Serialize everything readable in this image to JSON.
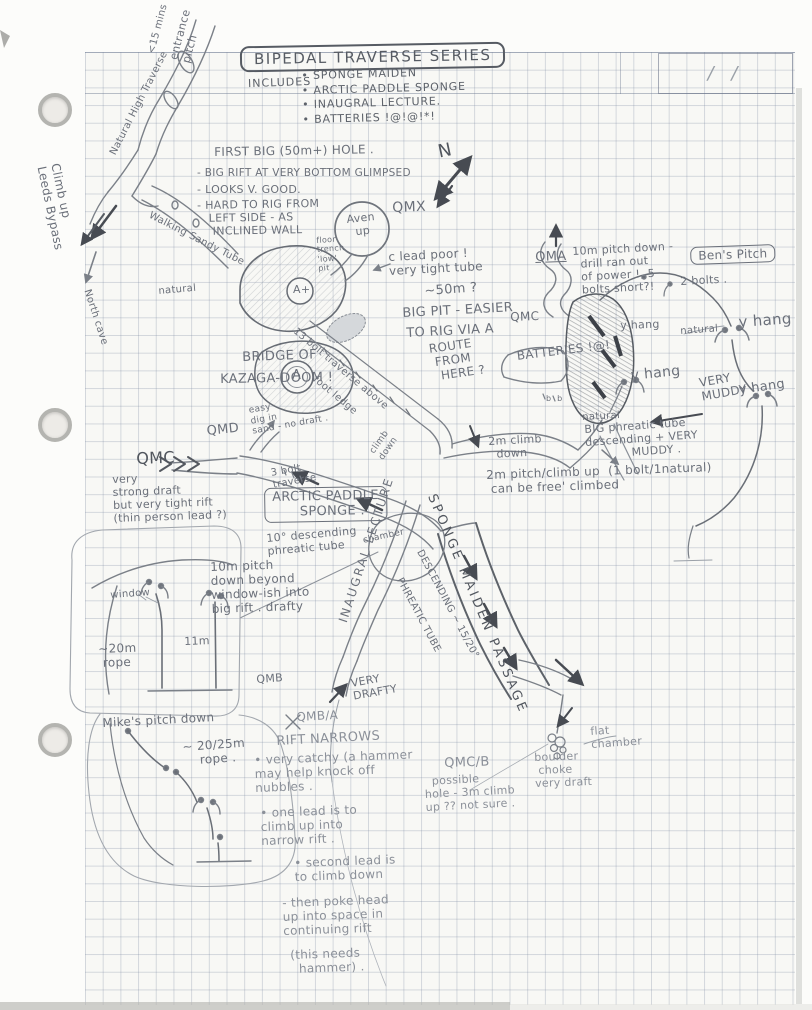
{
  "header": {
    "title": "BIPEDAL TRAVERSE SERIES",
    "includes_label": "INCLUDES",
    "includes": [
      "SPONGE MAIDEN",
      "ARCTIC PADDLE SPONGE",
      "INAUGRAL LECTURE.",
      "BATTERIES !@!@!*!"
    ],
    "date_box": "/    /"
  },
  "colors": {
    "pencil": "#6b707a",
    "pencil_dark": "#51565e",
    "pencil_faint": "#8b9099",
    "paper": "#f8f8f5",
    "grid_line": "#7d8aa2"
  },
  "annotations": [
    {
      "id": "entrance-pitch",
      "text": "entrance\npitch",
      "x": 168,
      "y": 58,
      "rot": -75,
      "fs": 11
    },
    {
      "id": "entrance-time",
      "text": "<15 mins",
      "x": 146,
      "y": 52,
      "rot": -75,
      "fs": 10
    },
    {
      "id": "natural-high-traverse",
      "text": "Natural High Traverse",
      "x": 108,
      "y": 152,
      "rot": -63,
      "fs": 10
    },
    {
      "id": "climb-up-leeds-bypass",
      "text": "Climb up\nLeeds Bypass",
      "x": 62,
      "y": 162,
      "rot": 78,
      "fs": 12
    },
    {
      "id": "north-cave",
      "text": "North cave",
      "x": 92,
      "y": 288,
      "rot": 72,
      "fs": 10
    },
    {
      "id": "first-big-hole-title",
      "text": "FIRST BIG (50m+) HOLE .",
      "x": 214,
      "y": 145,
      "rot": -1,
      "fs": 12
    },
    {
      "id": "first-big-hole-note-1",
      "text": "- BIG RIFT AT VERY BOTTOM GLIMPSED",
      "x": 197,
      "y": 167,
      "rot": 0,
      "fs": 10.5
    },
    {
      "id": "first-big-hole-note-2",
      "text": "- LOOKS V. GOOD.",
      "x": 197,
      "y": 184,
      "rot": 0,
      "fs": 11
    },
    {
      "id": "first-big-hole-note-3",
      "text": "- HARD TO RIG FROM\n   LEFT SIDE - AS\n    INCLINED WALL",
      "x": 197,
      "y": 200,
      "rot": -1,
      "fs": 11
    },
    {
      "id": "north-arrow-label",
      "text": "N",
      "x": 436,
      "y": 142,
      "rot": -12,
      "fs": 18,
      "cls": "dark"
    },
    {
      "id": "aven-up",
      "text": "Aven\n  up",
      "x": 346,
      "y": 214,
      "rot": -6,
      "fs": 11
    },
    {
      "id": "qmx",
      "text": "QMX",
      "x": 392,
      "y": 200,
      "rot": -2,
      "fs": 14
    },
    {
      "id": "floor-trench-pit",
      "text": "floor\ntrench\n'low'\npit",
      "x": 316,
      "y": 236,
      "rot": -4,
      "fs": 8
    },
    {
      "id": "walking-sandy-tube",
      "text": "Walking Sandy Tube",
      "x": 152,
      "y": 210,
      "rot": 27,
      "fs": 10
    },
    {
      "id": "natural-top",
      "text": "natural",
      "x": 158,
      "y": 286,
      "rot": -5,
      "fs": 10
    },
    {
      "id": "a-plus-label",
      "text": "A+",
      "x": 293,
      "y": 284,
      "rot": 0,
      "fs": 11
    },
    {
      "id": "a-pit-label",
      "text": "A",
      "x": 292,
      "y": 368,
      "rot": 0,
      "fs": 13
    },
    {
      "id": "c-lead-poor",
      "text": "c lead poor !\nvery tight tube",
      "x": 388,
      "y": 250,
      "rot": -3,
      "fs": 12
    },
    {
      "id": "big-pit-1",
      "text": "~50m ?",
      "x": 424,
      "y": 284,
      "rot": -4,
      "fs": 13
    },
    {
      "id": "big-pit-2",
      "text": "BIG PIT - EASIER",
      "x": 402,
      "y": 306,
      "rot": -3,
      "fs": 13
    },
    {
      "id": "big-pit-3",
      "text": "TO RIG VIA A",
      "x": 406,
      "y": 326,
      "rot": -3,
      "fs": 13
    },
    {
      "id": "big-pit-4",
      "text": "ROUTE\n FROM\n  HERE ?",
      "x": 428,
      "y": 342,
      "rot": -8,
      "fs": 12
    },
    {
      "id": "qma",
      "text": "QMA",
      "x": 535,
      "y": 250,
      "rot": -2,
      "fs": 13,
      "cls": "underline"
    },
    {
      "id": "qma-note",
      "text": "10m pitch down -\n  drill ran out\n  of power !, 5\n  bolts short?!",
      "x": 572,
      "y": 246,
      "rot": -3,
      "fs": 11
    },
    {
      "id": "bens-pitch",
      "text": "Ben's Pitch",
      "x": 690,
      "y": 247,
      "rot": -2,
      "fs": 12,
      "cls": "boxed"
    },
    {
      "id": "two-bolts",
      "text": "2 bolts .",
      "x": 680,
      "y": 276,
      "rot": -3,
      "fs": 11
    },
    {
      "id": "qmc-right",
      "text": "QMC",
      "x": 510,
      "y": 310,
      "rot": -2,
      "fs": 12
    },
    {
      "id": "y-hang-1",
      "text": "y hang",
      "x": 620,
      "y": 320,
      "rot": -2,
      "fs": 11
    },
    {
      "id": "natural-right-1",
      "text": "natural",
      "x": 680,
      "y": 326,
      "rot": -4,
      "fs": 10
    },
    {
      "id": "y-hang-2",
      "text": "y hang",
      "x": 738,
      "y": 314,
      "rot": -4,
      "fs": 15
    },
    {
      "id": "y-hang-3",
      "text": "y hang",
      "x": 630,
      "y": 368,
      "rot": -6,
      "fs": 14
    },
    {
      "id": "very-muddy",
      "text": "VERY\nMUDDY !",
      "x": 698,
      "y": 376,
      "rot": -10,
      "fs": 12
    },
    {
      "id": "y-hang-4",
      "text": "y hang",
      "x": 738,
      "y": 383,
      "rot": -8,
      "fs": 13
    },
    {
      "id": "batteries-label",
      "text": "BATTERIES !@!",
      "x": 516,
      "y": 349,
      "rot": -7,
      "fs": 12
    },
    {
      "id": "bridge-of",
      "text": "BRIDGE OF",
      "x": 242,
      "y": 350,
      "rot": -2,
      "fs": 13
    },
    {
      "id": "kazaga-doom",
      "text": "KAZAGA-DOOM !",
      "x": 220,
      "y": 372,
      "rot": -1,
      "fs": 13
    },
    {
      "id": "bolt-traverse-13a",
      "text": "13 bolt traverse above",
      "x": 298,
      "y": 326,
      "rot": 40,
      "fs": 10
    },
    {
      "id": "bolt-traverse-13b",
      "text": "foot ledge",
      "x": 318,
      "y": 374,
      "rot": 40,
      "fs": 10
    },
    {
      "id": "qmd",
      "text": "QMD",
      "x": 206,
      "y": 424,
      "rot": -6,
      "fs": 13
    },
    {
      "id": "qmd-note",
      "text": "easy\ndig in\nsand - no draft .",
      "x": 248,
      "y": 406,
      "rot": -10,
      "fs": 9
    },
    {
      "id": "qmc-left",
      "text": "QMC",
      "x": 136,
      "y": 450,
      "rot": -2,
      "fs": 16,
      "cls": "dark"
    },
    {
      "id": "qmc-left-note",
      "text": "very\nstrong draft\nbut very tight rift\n(thin person lead ?)",
      "x": 112,
      "y": 474,
      "rot": -2,
      "fs": 11
    },
    {
      "id": "three-bolt-traverse",
      "text": "3 bolt\ntraverse",
      "x": 270,
      "y": 468,
      "rot": -10,
      "fs": 10
    },
    {
      "id": "climb-down-rot",
      "text": "climb\ndown",
      "x": 368,
      "y": 450,
      "rot": -55,
      "fs": 9
    },
    {
      "id": "arctic-paddle-sponge",
      "text": "ARCTIC PADDLE\n   SPONGE .",
      "x": 264,
      "y": 488,
      "rot": -1,
      "fs": 13,
      "cls": "boxed"
    },
    {
      "id": "descending-10",
      "text": "10° descending\nphreatic tube",
      "x": 266,
      "y": 533,
      "rot": -5,
      "fs": 11
    },
    {
      "id": "inaugral-lecture",
      "text": "INAUGRAL LECTURE",
      "x": 336,
      "y": 620,
      "rot": -72,
      "fs": 12,
      "ls": 2
    },
    {
      "id": "chamber",
      "text": "chamber",
      "x": 362,
      "y": 536,
      "rot": -12,
      "fs": 9
    },
    {
      "id": "sponge-maiden-passage",
      "text": "SPONGE MAIDEN PASSAGE",
      "x": 438,
      "y": 492,
      "rot": 67,
      "fs": 13,
      "ls": 3,
      "cls": "dark"
    },
    {
      "id": "descending-1520",
      "text": "DESCENDING ~ 15/20°",
      "x": 424,
      "y": 548,
      "rot": 62,
      "fs": 10
    },
    {
      "id": "phreatic-tube",
      "text": "PHREATIC TUBE",
      "x": 404,
      "y": 576,
      "rot": 62,
      "fs": 10
    },
    {
      "id": "pitch-10m-window",
      "text": "10m pitch\ndown beyond\nwindow-ish into\nbig rift . drafty",
      "x": 210,
      "y": 560,
      "rot": -2,
      "fs": 12
    },
    {
      "id": "window",
      "text": "window",
      "x": 110,
      "y": 590,
      "rot": -4,
      "fs": 10
    },
    {
      "id": "eleven-m",
      "text": "11m",
      "x": 184,
      "y": 636,
      "rot": -2,
      "fs": 11
    },
    {
      "id": "rope-20m",
      "text": "~20m\n rope",
      "x": 98,
      "y": 642,
      "rot": -2,
      "fs": 12
    },
    {
      "id": "qmb",
      "text": "QMB",
      "x": 256,
      "y": 674,
      "rot": -4,
      "fs": 11
    },
    {
      "id": "very-drafty",
      "text": "VERY\nDRAFTY",
      "x": 350,
      "y": 678,
      "rot": -10,
      "fs": 11
    },
    {
      "id": "qmb-a",
      "text": "QMB/A",
      "x": 296,
      "y": 710,
      "rot": -3,
      "fs": 12,
      "cls": "faint"
    },
    {
      "id": "rift-narrows",
      "text": "RIFT NARROWS",
      "x": 276,
      "y": 734,
      "rot": -3,
      "fs": 13,
      "cls": "faint"
    },
    {
      "id": "rift-note-1",
      "text": "• very catchy (a hammer\nmay help knock off\nnubbles .",
      "x": 254,
      "y": 753,
      "rot": -2,
      "fs": 12,
      "cls": "faint"
    },
    {
      "id": "rift-note-2",
      "text": "• one lead is to\nclimb up into\nnarrow rift .",
      "x": 260,
      "y": 806,
      "rot": -2,
      "fs": 12,
      "cls": "faint"
    },
    {
      "id": "rift-note-3",
      "text": "• second lead is\nto climb down",
      "x": 294,
      "y": 856,
      "rot": -2,
      "fs": 12,
      "cls": "faint"
    },
    {
      "id": "rift-note-4",
      "text": "- then poke head\nup into space in\ncontinuing rift",
      "x": 282,
      "y": 896,
      "rot": -2,
      "fs": 12,
      "cls": "faint"
    },
    {
      "id": "rift-note-5",
      "text": "(this needs\n  hammer) .",
      "x": 290,
      "y": 948,
      "rot": -2,
      "fs": 12,
      "cls": "faint"
    },
    {
      "id": "qmc-b",
      "text": "QMC/B",
      "x": 444,
      "y": 756,
      "rot": -2,
      "fs": 13,
      "cls": "faint"
    },
    {
      "id": "qmc-b-note",
      "text": "  possible\nhole - 3m climb\nup ?? not sure .",
      "x": 424,
      "y": 776,
      "rot": -3,
      "fs": 11,
      "cls": "faint"
    },
    {
      "id": "boulder-choke",
      "text": "boulder\n choke\nvery draft",
      "x": 534,
      "y": 752,
      "rot": -2,
      "fs": 11,
      "cls": "faint"
    },
    {
      "id": "flat-chamber",
      "text": "flat\nchamber",
      "x": 590,
      "y": 726,
      "rot": -4,
      "fs": 11,
      "cls": "faint"
    },
    {
      "id": "mikes-pitch",
      "text": "Mike's pitch down",
      "x": 102,
      "y": 716,
      "rot": -3,
      "fs": 12
    },
    {
      "id": "mikes-rope",
      "text": "~ 20/25m\n    rope .",
      "x": 182,
      "y": 740,
      "rot": -4,
      "fs": 12
    },
    {
      "id": "natural-mid",
      "text": "natural",
      "x": 582,
      "y": 412,
      "rot": -3,
      "fs": 10
    },
    {
      "id": "big-phreatic",
      "text": "BIG phreatic tube\ndescending + VERY\n            MUDDY .",
      "x": 584,
      "y": 424,
      "rot": -4,
      "fs": 11
    },
    {
      "id": "two-m-climb",
      "text": "2m climb\n  down",
      "x": 488,
      "y": 436,
      "rot": -3,
      "fs": 11
    },
    {
      "id": "two-m-pitch",
      "text": "2m pitch/climb up  (1 bolt/1natural)\n can be free' climbed",
      "x": 486,
      "y": 468,
      "rot": -2,
      "fs": 12
    },
    {
      "id": "b-marks",
      "text": "b  b",
      "x": 546,
      "y": 394,
      "rot": 0,
      "fs": 8
    }
  ]
}
